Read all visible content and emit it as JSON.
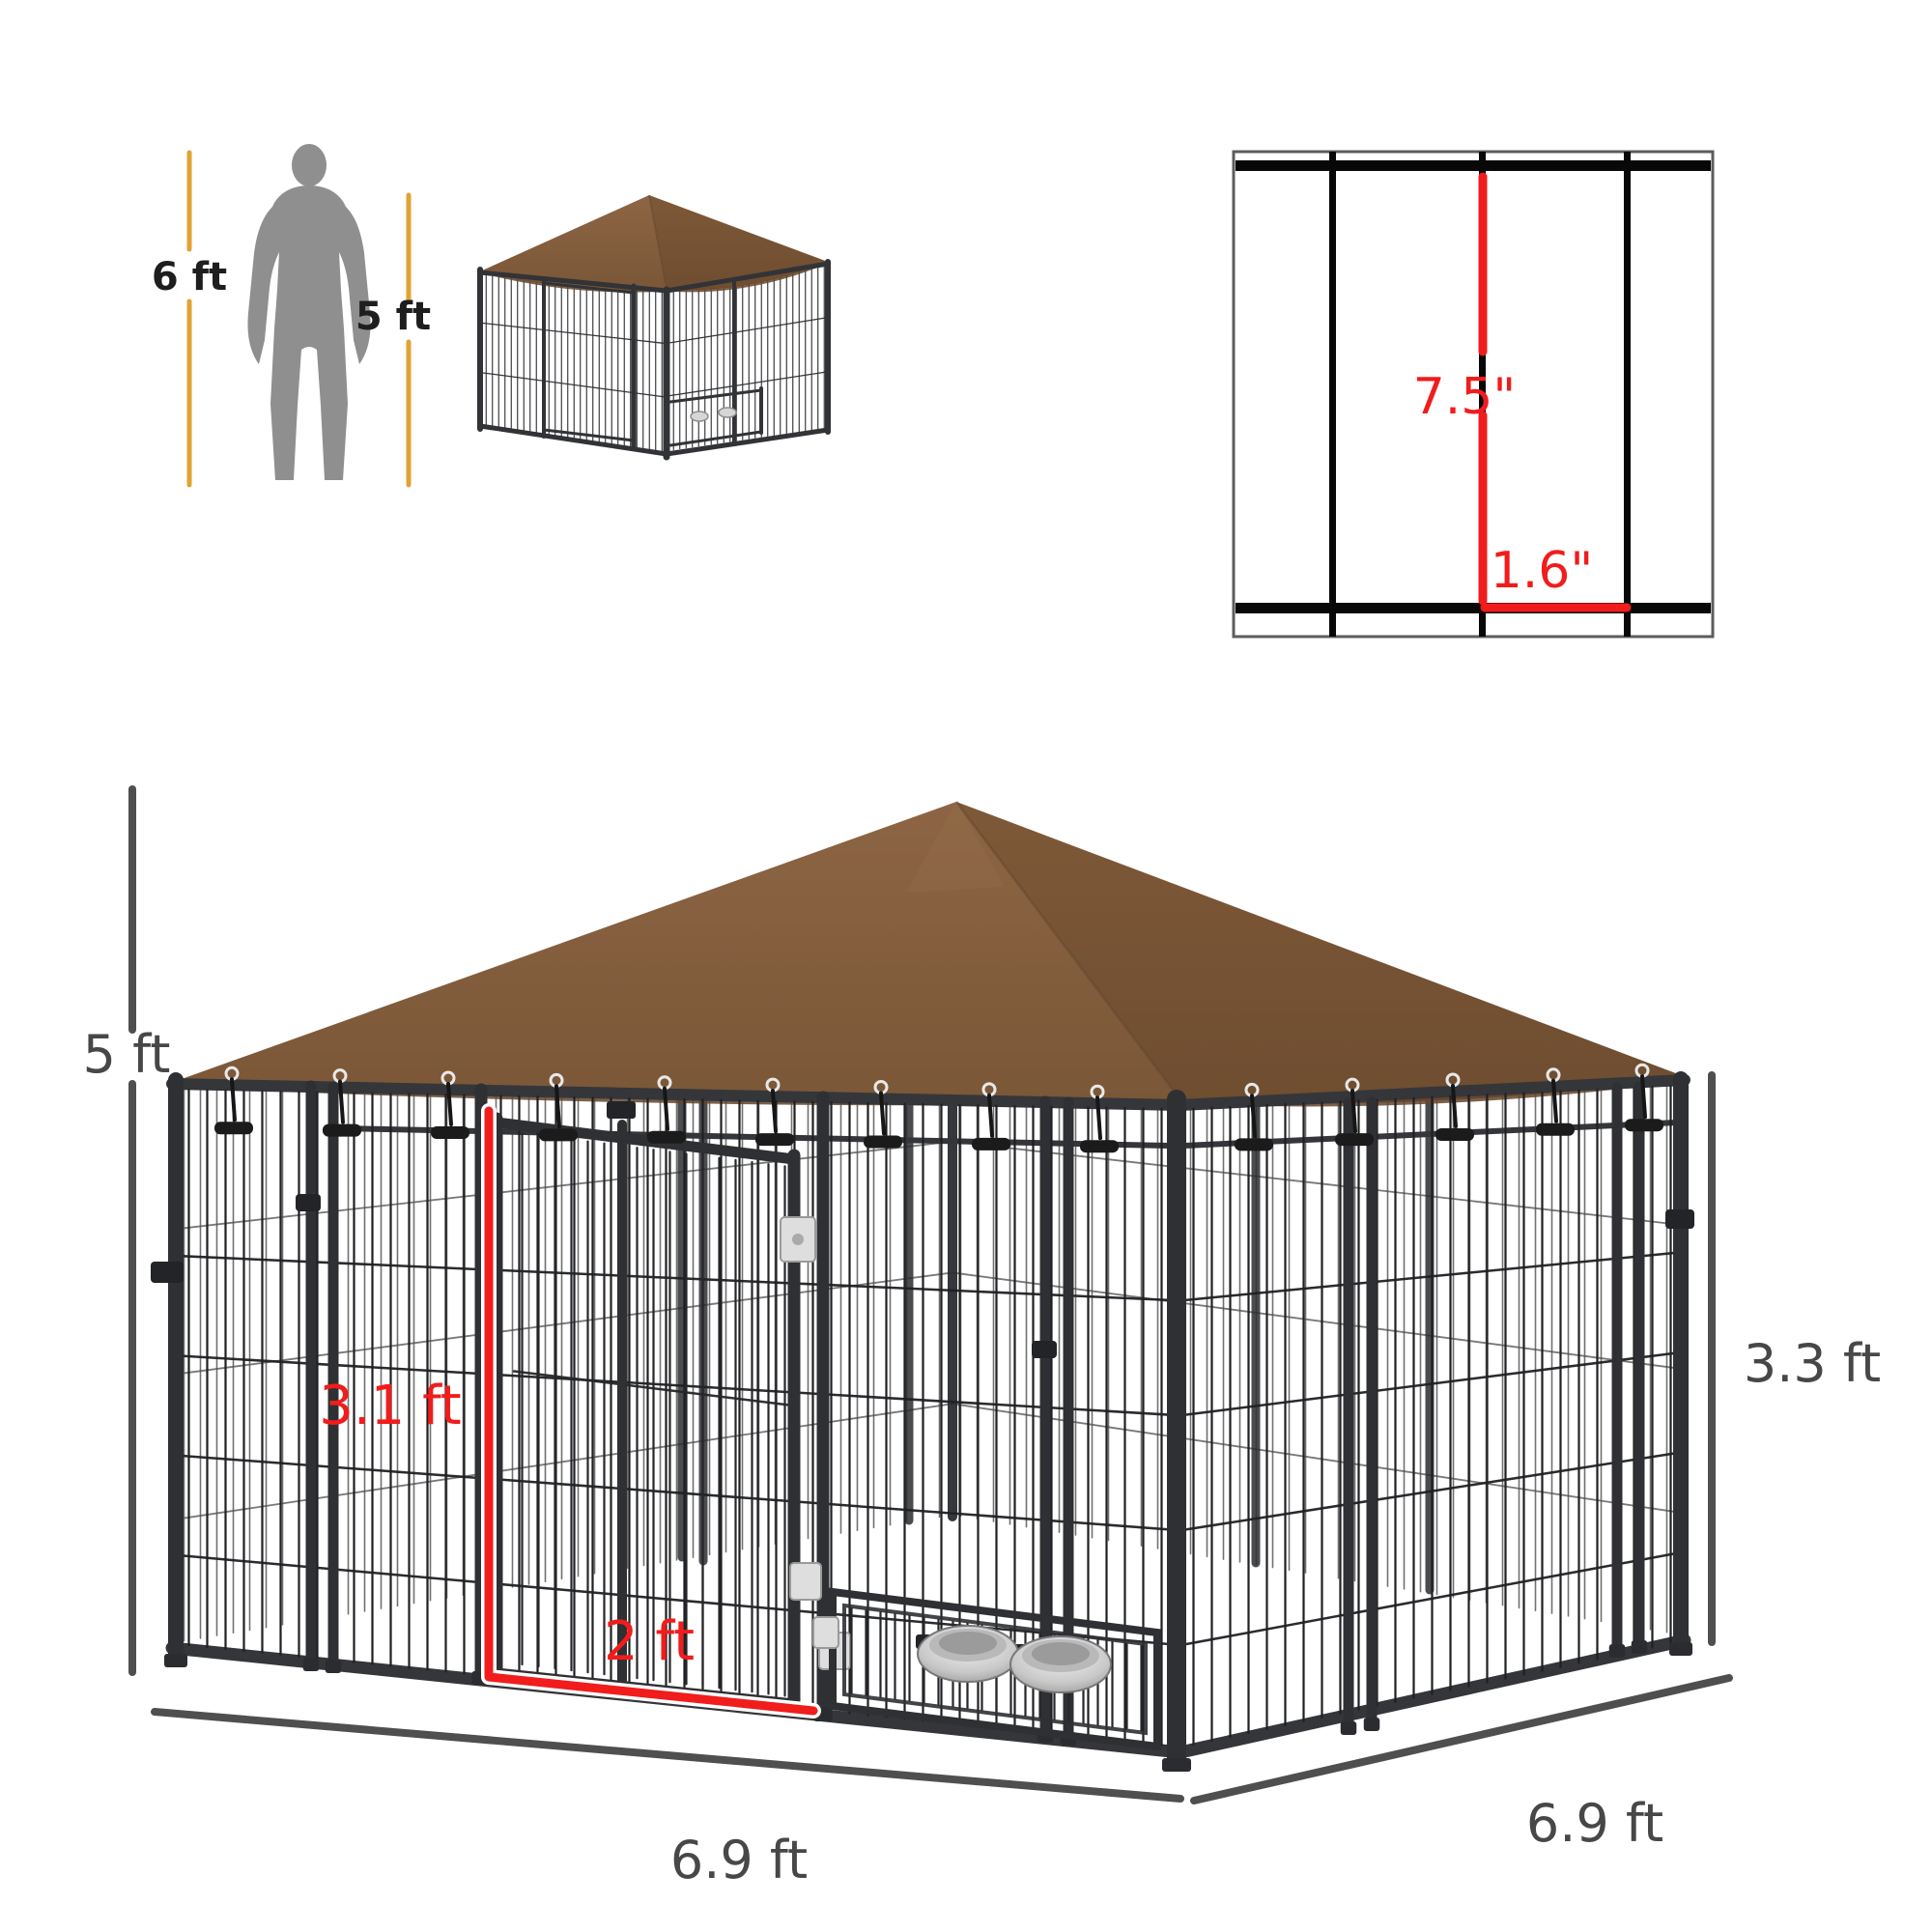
{
  "scale_reference": {
    "person_height_label": "6 ft",
    "kennel_height_label": "5 ft"
  },
  "mesh_spacing": {
    "vertical_gap_label": "7.5\"",
    "horizontal_gap_label": "1.6\""
  },
  "dimensions": {
    "total_height_label": "5 ft",
    "side_panel_height_label": "3.3 ft",
    "door_height_label": "3.1 ft",
    "door_width_label": "2 ft",
    "base_width_label": "6.9 ft",
    "base_depth_label": "6.9 ft"
  },
  "colors": {
    "canopy_brown": "#835b3a",
    "frame_black": "#2f3033",
    "dimension_gray": "#474747",
    "highlight_red": "#f11c1c",
    "scale_line_yellow": "#e2a233",
    "person_gray": "#8f8f8f"
  }
}
